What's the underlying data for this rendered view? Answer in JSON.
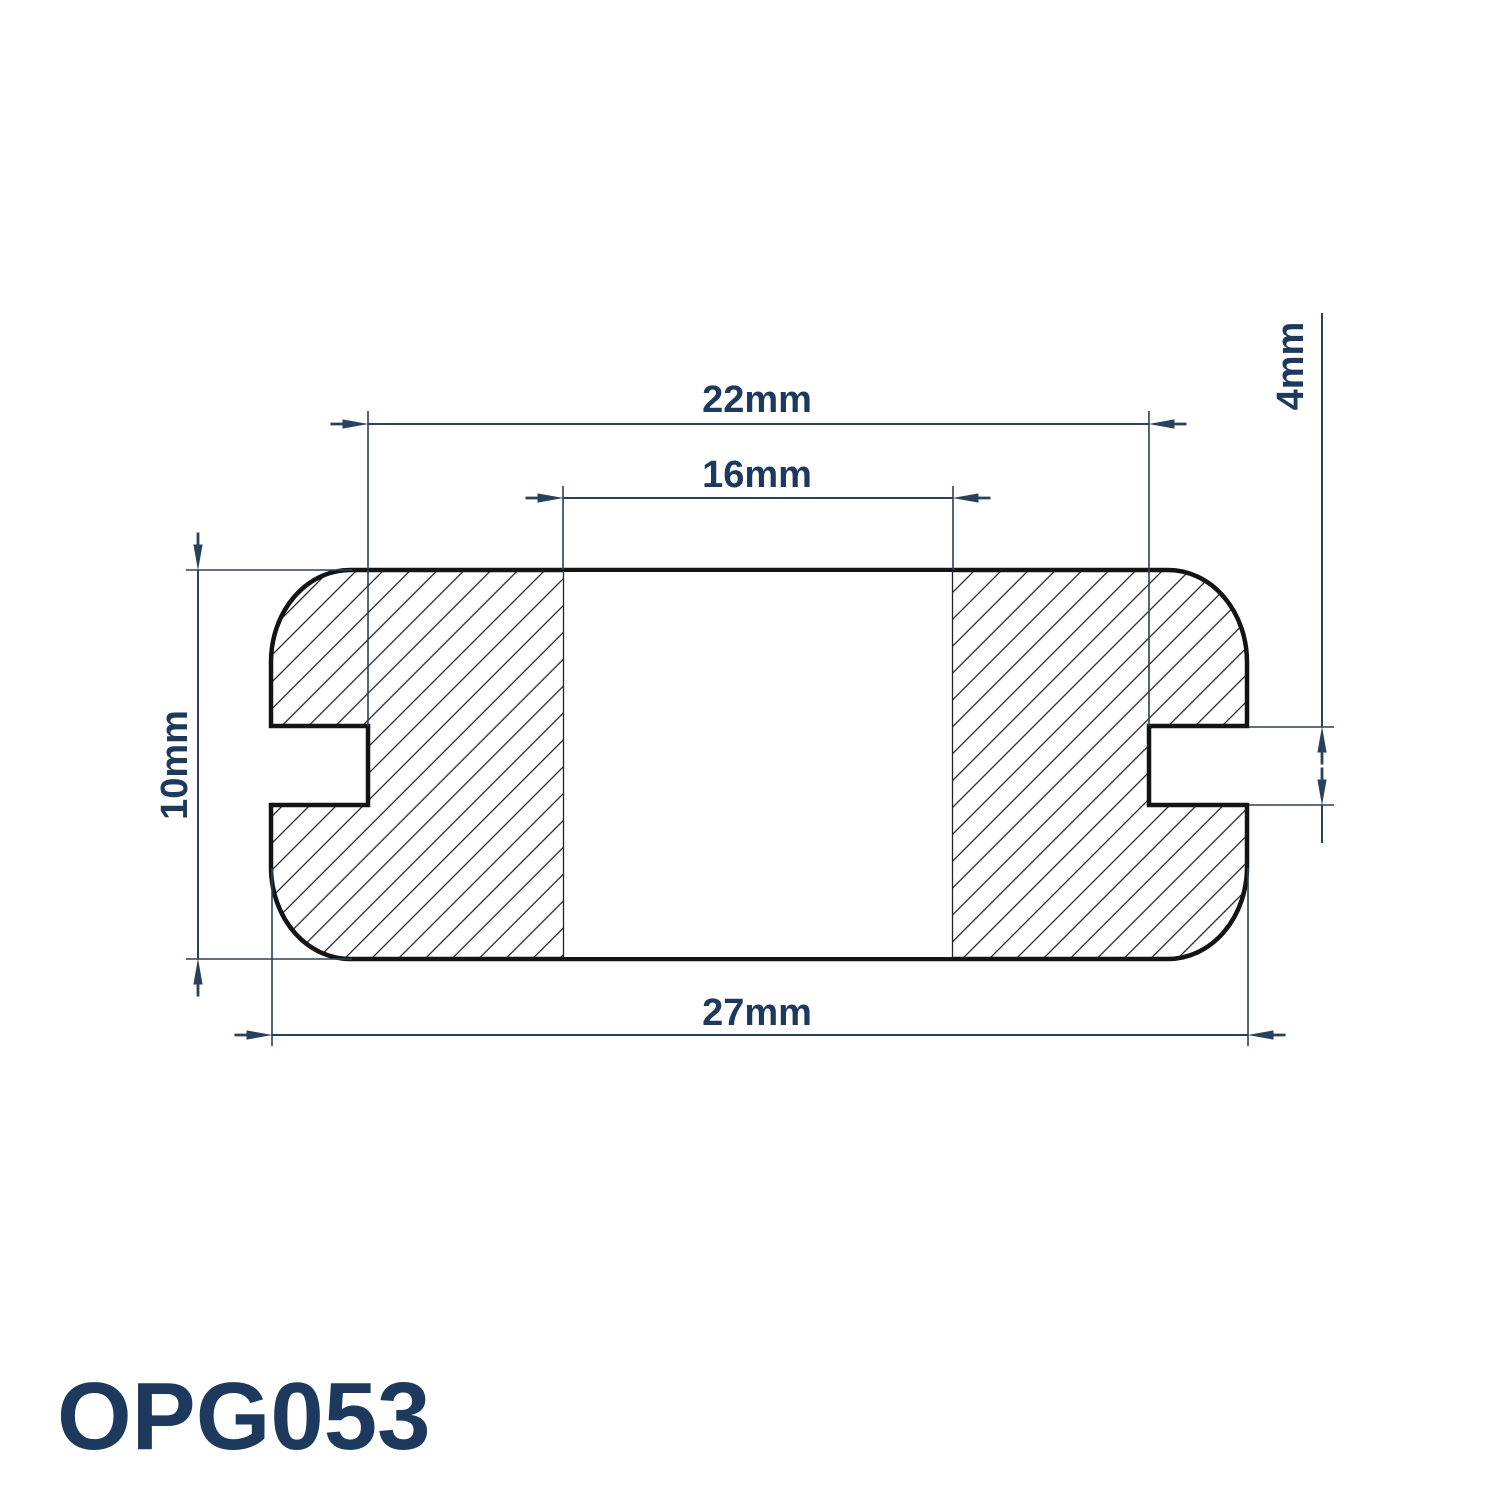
{
  "drawing": {
    "part_number": "OPG053",
    "dimensions": {
      "groove_diameter": "22mm",
      "inner_diameter": "16mm",
      "overall_height": "10mm",
      "flange_diameter": "27mm",
      "groove_width": "4mm"
    },
    "colors": {
      "outline": "#141414",
      "dimension_lines": "#2a415c",
      "label_text": "#1d3a5e",
      "background": "#ffffff"
    }
  }
}
